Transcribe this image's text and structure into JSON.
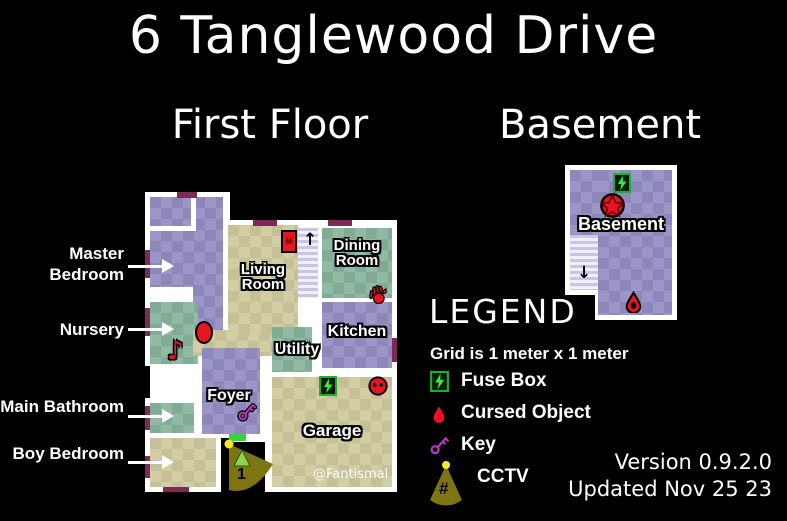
{
  "title": "6 Tanglewood Drive",
  "floors": {
    "first": "First Floor",
    "basement": "Basement"
  },
  "side_labels": {
    "master_bedroom": "Master Bedroom",
    "nursery": "Nursery",
    "main_bathroom": "Main Bathroom",
    "boy_bedroom": "Boy Bedroom"
  },
  "rooms": {
    "living": "Living Room",
    "dining": "Dining Room",
    "kitchen": "Kitchen",
    "utility": "Utility",
    "foyer": "Foyer",
    "garage": "Garage",
    "basement": "Basement"
  },
  "cctv": {
    "camera_1": "1"
  },
  "watermark": "@Fantismal",
  "legend": {
    "heading": "LEGEND",
    "grid_note": "Grid is 1 meter x 1 meter",
    "items": [
      {
        "icon": "fuse-box-icon",
        "label": "Fuse Box"
      },
      {
        "icon": "cursed-object-icon",
        "label": "Cursed Object"
      },
      {
        "icon": "key-icon",
        "label": "Key"
      },
      {
        "icon": "cctv-icon",
        "label": "CCTV"
      }
    ]
  },
  "footer": {
    "version": "Version 0.9.2.0",
    "updated": "Updated Nov 25 23"
  },
  "colors": {
    "background": "#000000",
    "wall": "#ffffff",
    "accent_red": "#e81420",
    "fuse_green": "#35f03a",
    "key_magenta": "#b13ab5",
    "cctv_olive": "#7e7413",
    "window_maroon": "#7c2a57",
    "room_purple": "#9c95c7",
    "room_green": "#8fbaa3",
    "room_tan": "#d2cda3"
  }
}
